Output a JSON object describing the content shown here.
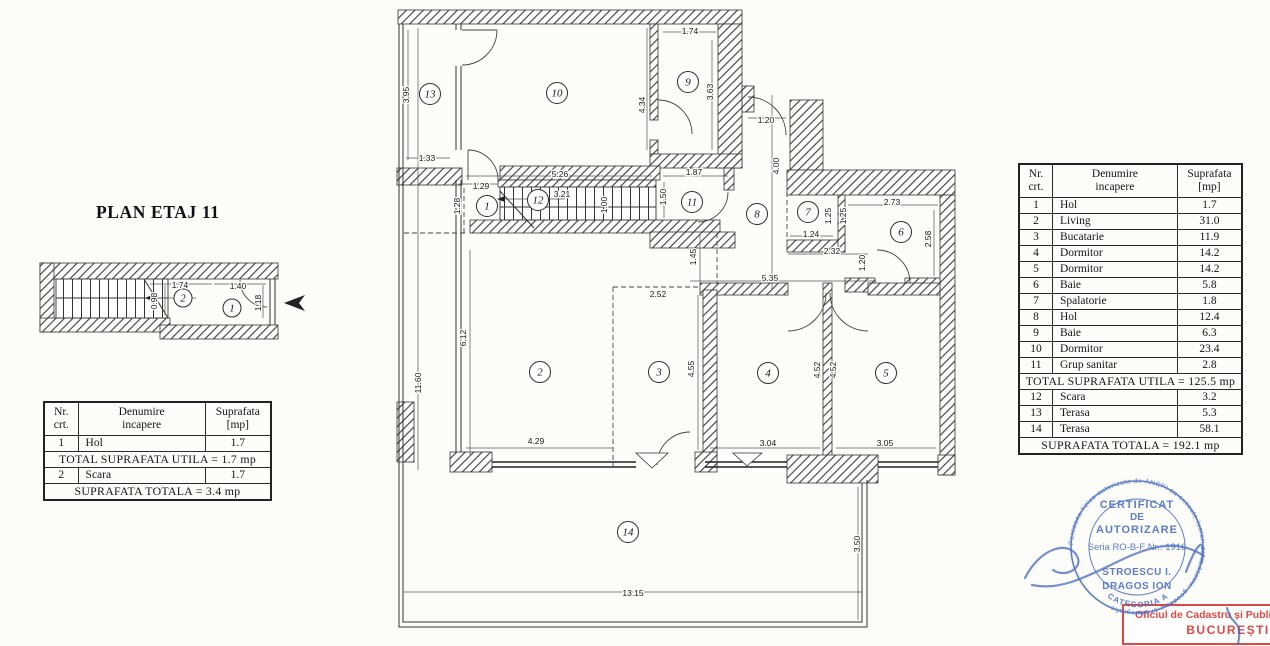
{
  "title": "PLAN ETAJ 11",
  "colors": {
    "ink": "#2b2b2b",
    "stamp_blue": "#4a6dc0",
    "stamp_red": "#e04848"
  },
  "tables": {
    "headers": [
      [
        "Nr.",
        "crt."
      ],
      [
        "Denumire",
        "incapere"
      ],
      [
        "Suprafata",
        "[mp]"
      ]
    ],
    "left": {
      "sections": [
        {
          "rows": [
            [
              "1",
              "Hol",
              "1.7"
            ]
          ]
        },
        {
          "text": "TOTAL SUPRAFATA UTILA = 1.7 mp"
        },
        {
          "rows": [
            [
              "2",
              "Scara",
              "1.7"
            ]
          ]
        },
        {
          "text": "SUPRAFATA TOTALA = 3.4 mp"
        }
      ]
    },
    "right": {
      "sections": [
        {
          "rows": [
            [
              "1",
              "Hol",
              "1.7"
            ],
            [
              "2",
              "Living",
              "31.0"
            ],
            [
              "3",
              "Bucatarie",
              "11.9"
            ],
            [
              "4",
              "Dormitor",
              "14.2"
            ],
            [
              "5",
              "Dormitor",
              "14.2"
            ],
            [
              "6",
              "Baie",
              "5.8"
            ],
            [
              "7",
              "Spalatorie",
              "1.8"
            ],
            [
              "8",
              "Hol",
              "12.4"
            ],
            [
              "9",
              "Baie",
              "6.3"
            ],
            [
              "10",
              "Dormitor",
              "23.4"
            ],
            [
              "11",
              "Grup sanitar",
              "2.8"
            ]
          ]
        },
        {
          "text": "TOTAL SUPRAFATA UTILA = 125.5 mp"
        },
        {
          "rows": [
            [
              "12",
              "Scara",
              "3.2"
            ],
            [
              "13",
              "Terasa",
              "5.3"
            ],
            [
              "14",
              "Terasa",
              "58.1"
            ]
          ]
        },
        {
          "text": "SUPRAFATA TOTALA = 192.1 mp"
        }
      ]
    }
  },
  "main_plan": {
    "r": 10.5,
    "circles": [
      {
        "n": "13",
        "x": 430,
        "y": 94
      },
      {
        "n": "10",
        "x": 557,
        "y": 93
      },
      {
        "n": "9",
        "x": 688,
        "y": 82
      },
      {
        "n": "1",
        "x": 487,
        "y": 206
      },
      {
        "n": "12",
        "x": 538,
        "y": 200
      },
      {
        "n": "11",
        "x": 692,
        "y": 202
      },
      {
        "n": "8",
        "x": 757,
        "y": 214
      },
      {
        "n": "7",
        "x": 808,
        "y": 212
      },
      {
        "n": "6",
        "x": 901,
        "y": 232
      },
      {
        "n": "2",
        "x": 540,
        "y": 372
      },
      {
        "n": "3",
        "x": 659,
        "y": 372
      },
      {
        "n": "4",
        "x": 768,
        "y": 373
      },
      {
        "n": "5",
        "x": 886,
        "y": 373
      },
      {
        "n": "14",
        "x": 628,
        "y": 532
      }
    ],
    "dims": [
      {
        "t": "3.95",
        "x": 409,
        "y": 95,
        "v": 1
      },
      {
        "t": "1.33",
        "x": 427,
        "y": 161
      },
      {
        "t": "11.60",
        "x": 421,
        "y": 383,
        "v": 1
      },
      {
        "t": "1.74",
        "x": 690,
        "y": 34
      },
      {
        "t": "3.63",
        "x": 713,
        "y": 92,
        "v": 1
      },
      {
        "t": "4.34",
        "x": 645,
        "y": 105,
        "v": 1
      },
      {
        "t": "5.26",
        "x": 560,
        "y": 177
      },
      {
        "t": "1.29",
        "x": 481,
        "y": 189
      },
      {
        "t": "1.28",
        "x": 460,
        "y": 206,
        "v": 1
      },
      {
        "t": "3.21",
        "x": 562,
        "y": 197
      },
      {
        "t": "1.00",
        "x": 607,
        "y": 205,
        "v": 1
      },
      {
        "t": "1.87",
        "x": 694,
        "y": 175
      },
      {
        "t": "1.50",
        "x": 666,
        "y": 197,
        "v": 1
      },
      {
        "t": "1.20",
        "x": 766,
        "y": 123
      },
      {
        "t": "4.00",
        "x": 779,
        "y": 166,
        "v": 1
      },
      {
        "t": "1.25",
        "x": 831,
        "y": 216,
        "v": 1
      },
      {
        "t": "1.25",
        "x": 846,
        "y": 216,
        "v": 1
      },
      {
        "t": "2.73",
        "x": 892,
        "y": 205
      },
      {
        "t": "2.58",
        "x": 931,
        "y": 239,
        "v": 1
      },
      {
        "t": "1.24",
        "x": 811,
        "y": 237
      },
      {
        "t": "2.32",
        "x": 832,
        "y": 254
      },
      {
        "t": "1.20",
        "x": 865,
        "y": 263,
        "v": 1
      },
      {
        "t": "5.35",
        "x": 770,
        "y": 281
      },
      {
        "t": "1.45",
        "x": 696,
        "y": 257,
        "v": 1
      },
      {
        "t": "2.52",
        "x": 658,
        "y": 297
      },
      {
        "t": "6.12",
        "x": 466,
        "y": 338,
        "v": 1
      },
      {
        "t": "4.29",
        "x": 536,
        "y": 444
      },
      {
        "t": "4.55",
        "x": 694,
        "y": 369,
        "v": 1
      },
      {
        "t": "3.04",
        "x": 768,
        "y": 446
      },
      {
        "t": "4.52",
        "x": 820,
        "y": 370,
        "v": 1
      },
      {
        "t": "4.52",
        "x": 836,
        "y": 370,
        "v": 1
      },
      {
        "t": "3.05",
        "x": 885,
        "y": 446
      },
      {
        "t": "13.15",
        "x": 633,
        "y": 596
      },
      {
        "t": "3.50",
        "x": 860,
        "y": 544,
        "v": 1
      }
    ]
  },
  "small_plan": {
    "r": 9,
    "circles": [
      {
        "n": "2",
        "x": 183,
        "y": 298
      },
      {
        "n": "1",
        "x": 232,
        "y": 308
      }
    ],
    "dims": [
      {
        "t": "1.74",
        "x": 180,
        "y": 288
      },
      {
        "t": "0.98",
        "x": 157,
        "y": 301,
        "v": 1
      },
      {
        "t": "1.40",
        "x": 238,
        "y": 289
      },
      {
        "t": "1.18",
        "x": 261,
        "y": 303,
        "v": 1
      }
    ]
  },
  "stamp_blue": {
    "line1": "CERTIFICAT",
    "line2": "DE",
    "line3": "AUTORIZARE",
    "serial": "Seria RO-B-F Nr.: 1916",
    "name1": "STROESCU I.",
    "name2": "DRAGOS ION",
    "category": "CATEGORIA A",
    "ring_text": "Persoana fizica autorizata de ANCPI sa execute lucrari de cadastru, geodezie si cartografie"
  },
  "stamp_red": {
    "line1": "Oficiul de Cadastru și Publicitat",
    "line2": "BUCUREȘTI"
  }
}
